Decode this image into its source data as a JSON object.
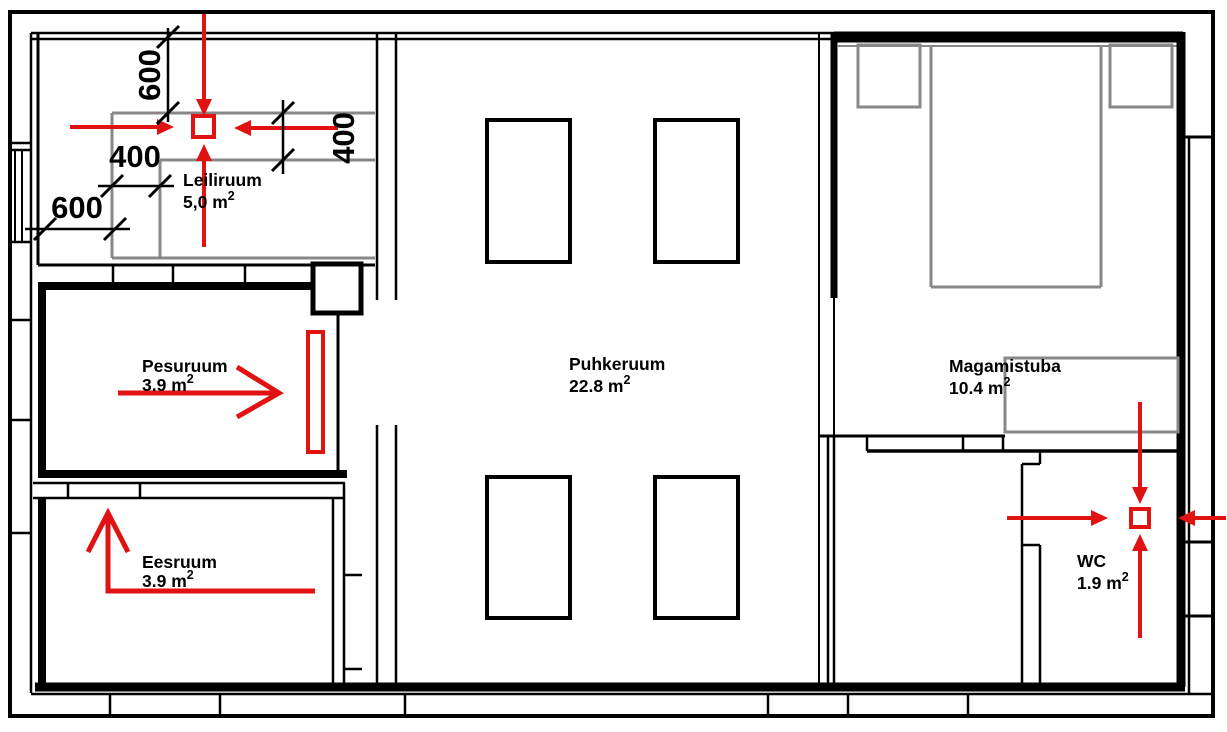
{
  "plan": {
    "rooms": [
      {
        "name": "Leiliruum",
        "area": "5,0 m",
        "area_sup": "2"
      },
      {
        "name": "Pesuruum",
        "area": "3.9 m",
        "area_sup": "2"
      },
      {
        "name": "Eesruum",
        "area": "3.9 m",
        "area_sup": "2"
      },
      {
        "name": "Puhkeruum",
        "area": "22.8 m",
        "area_sup": "2"
      },
      {
        "name": "Magamistuba",
        "area": "10.4 m",
        "area_sup": "2"
      },
      {
        "name": "WC",
        "area": "1.9 m",
        "area_sup": "2"
      }
    ],
    "dimensions": [
      {
        "value": "600",
        "orientation": "vertical",
        "location": "sauna-top"
      },
      {
        "value": "400",
        "orientation": "horizontal",
        "location": "sauna-left"
      },
      {
        "value": "400",
        "orientation": "vertical",
        "location": "sauna-right"
      },
      {
        "value": "600",
        "orientation": "horizontal",
        "location": "sauna-bottom-left"
      }
    ],
    "markers": {
      "heater_marker_room": "Leiliruum",
      "vent_marker_room": "WC",
      "arrows": [
        {
          "room": "Leiliruum",
          "direction": "down"
        },
        {
          "room": "Leiliruum",
          "direction": "up"
        },
        {
          "room": "Leiliruum",
          "direction": "right"
        },
        {
          "room": "Leiliruum",
          "direction": "left"
        },
        {
          "room": "Pesuruum",
          "direction": "right"
        },
        {
          "room": "Eesruum",
          "direction": "up"
        },
        {
          "room": "WC",
          "direction": "down"
        },
        {
          "room": "WC",
          "direction": "up"
        },
        {
          "room": "WC",
          "direction": "right"
        },
        {
          "room": "WC",
          "direction": "left"
        }
      ]
    },
    "colors": {
      "walls": "#000000",
      "markers_red": "#e01212",
      "furniture_gray": "#878787",
      "background": "#ffffff"
    }
  }
}
